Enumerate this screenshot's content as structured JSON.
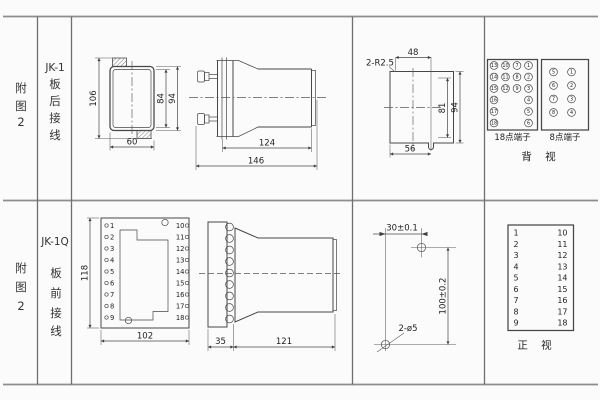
{
  "colors": {
    "line": "#474747",
    "grid": "#8d8d8d",
    "text": "#333333",
    "background": "#fbfbfb"
  },
  "rows": {
    "top": {
      "figure_label": [
        "附",
        "图",
        "2"
      ],
      "model": "JK-1",
      "wiring_label": [
        "板",
        "后",
        "接",
        "线"
      ],
      "case_view": {
        "dim_total_height": "106",
        "dim_inner_height": "84",
        "dim_case_height": "94",
        "dim_width": "60"
      },
      "side_view": {
        "dim_body_length": "124",
        "dim_total_length": "146"
      },
      "cutout_view": {
        "corner_radius": "2-R2.5",
        "dim_width_top": "48",
        "dim_inner_height": "81",
        "dim_height": "94",
        "dim_width_bottom": "56"
      },
      "terminal_18": {
        "label": "18点端子",
        "columns": [
          [
            "13",
            "14",
            "15",
            "16",
            "17",
            "18"
          ],
          [
            "10",
            "11",
            "12"
          ],
          [
            "7",
            "8",
            "9"
          ],
          [
            "1",
            "2",
            "3",
            "4",
            "5",
            "6"
          ]
        ]
      },
      "terminal_8": {
        "label": "8点端子",
        "columns": [
          [
            "5",
            "6",
            "7",
            "8"
          ],
          [
            "1",
            "2",
            "3",
            "4"
          ]
        ]
      },
      "view_label": "背  视"
    },
    "bottom": {
      "figure_label": [
        "附",
        "图",
        "2"
      ],
      "model": "JK-1Q",
      "wiring_label": [
        "板",
        "前",
        "接",
        "线"
      ],
      "socket_front": {
        "left_terminals": [
          "1",
          "2",
          "3",
          "4",
          "5",
          "6",
          "7",
          "8",
          "9"
        ],
        "right_terminals": [
          "10",
          "11",
          "12",
          "13",
          "14",
          "15",
          "16",
          "17",
          "18"
        ],
        "dim_height": "118",
        "dim_width": "102"
      },
      "socket_side": {
        "dim_flange": "35",
        "dim_body": "121"
      },
      "drill_view": {
        "dim_horizontal": "30±0.1",
        "dim_vertical": "100±0.2",
        "hole_label": "2-ø5"
      },
      "terminal_table": {
        "left": [
          "1",
          "2",
          "3",
          "4",
          "5",
          "6",
          "7",
          "8",
          "9"
        ],
        "right": [
          "10",
          "11",
          "12",
          "13",
          "14",
          "15",
          "16",
          "17",
          "18"
        ]
      },
      "view_label": "正  视"
    }
  }
}
